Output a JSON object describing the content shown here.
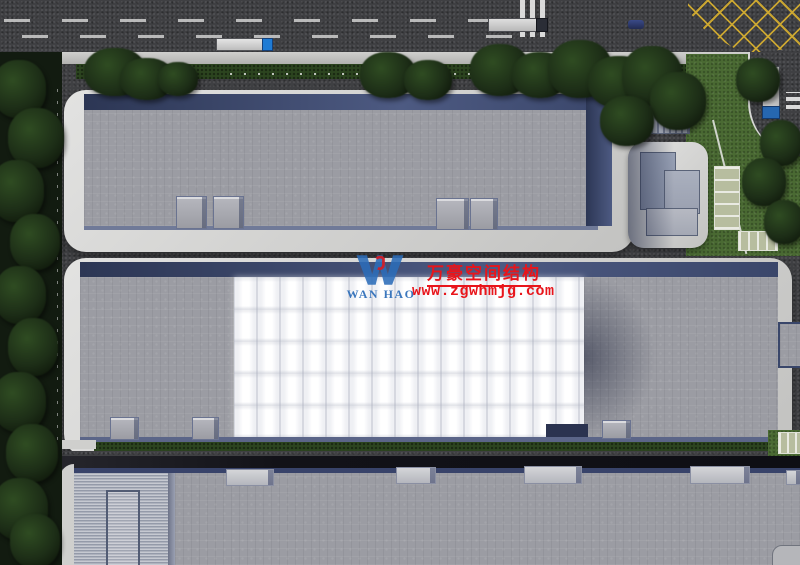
{
  "page": {
    "type": "aerial-architectural-rendering",
    "description": "Top-down 3D rendering of an industrial park: three long warehouse buildings, the middle one with a white air-supported membrane roof, roads with vehicles, lawns and parking"
  },
  "watermark": {
    "logo_text": "WAN HAO",
    "company_name_cn": "万豪空间结构",
    "website_url": "www.zgwhmjg.com"
  },
  "palette": {
    "asphalt": "#3f4043",
    "asphalt-dark": "#15151b",
    "roof-gray": "#9b9ca3",
    "roof-corrugated": "#aeb2bd",
    "wall-blue": "#39466a",
    "apron-white": "#d3d3d1",
    "membrane-white": "#f4f4f6",
    "grass-green": "#4a6a33",
    "hedge-green": "#2c441f",
    "tree-green": "#1d2e17",
    "marking-yellow": "#d0aa30",
    "watermark-red": "#e8151b",
    "watermark-blue": "#2b6cb8",
    "truck-cab-blue": "#1f7bd4"
  }
}
